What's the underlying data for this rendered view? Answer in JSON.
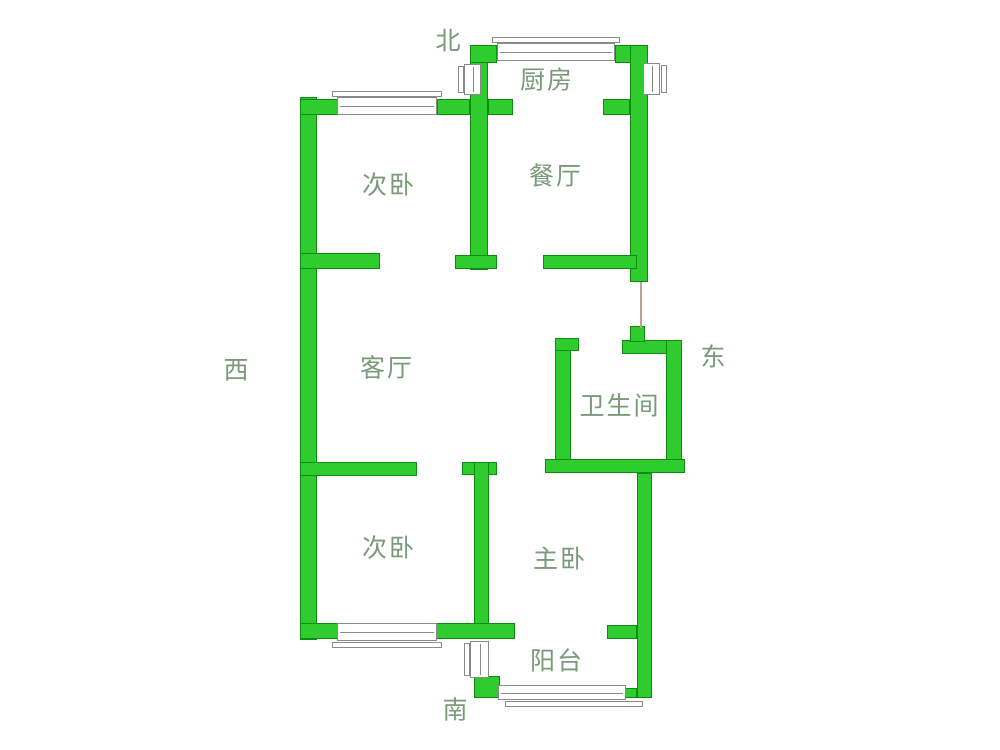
{
  "colors": {
    "background": "#ffffff",
    "wall_fill": "#2fcc2f",
    "wall_border": "#0f8c0f",
    "window_fill": "#ffffff",
    "window_border": "#8a8a8a",
    "label": "#7a9a7a",
    "passage_line": "#b3a693"
  },
  "compass": {
    "north": "北",
    "south": "南",
    "west": "西",
    "east": "东"
  },
  "rooms": {
    "kitchen": "厨房",
    "dining": "餐厅",
    "bedroom_north": "次卧",
    "living": "客厅",
    "bathroom": "卫生间",
    "bedroom_south": "次卧",
    "master_bedroom": "主卧",
    "balcony": "阳台"
  }
}
